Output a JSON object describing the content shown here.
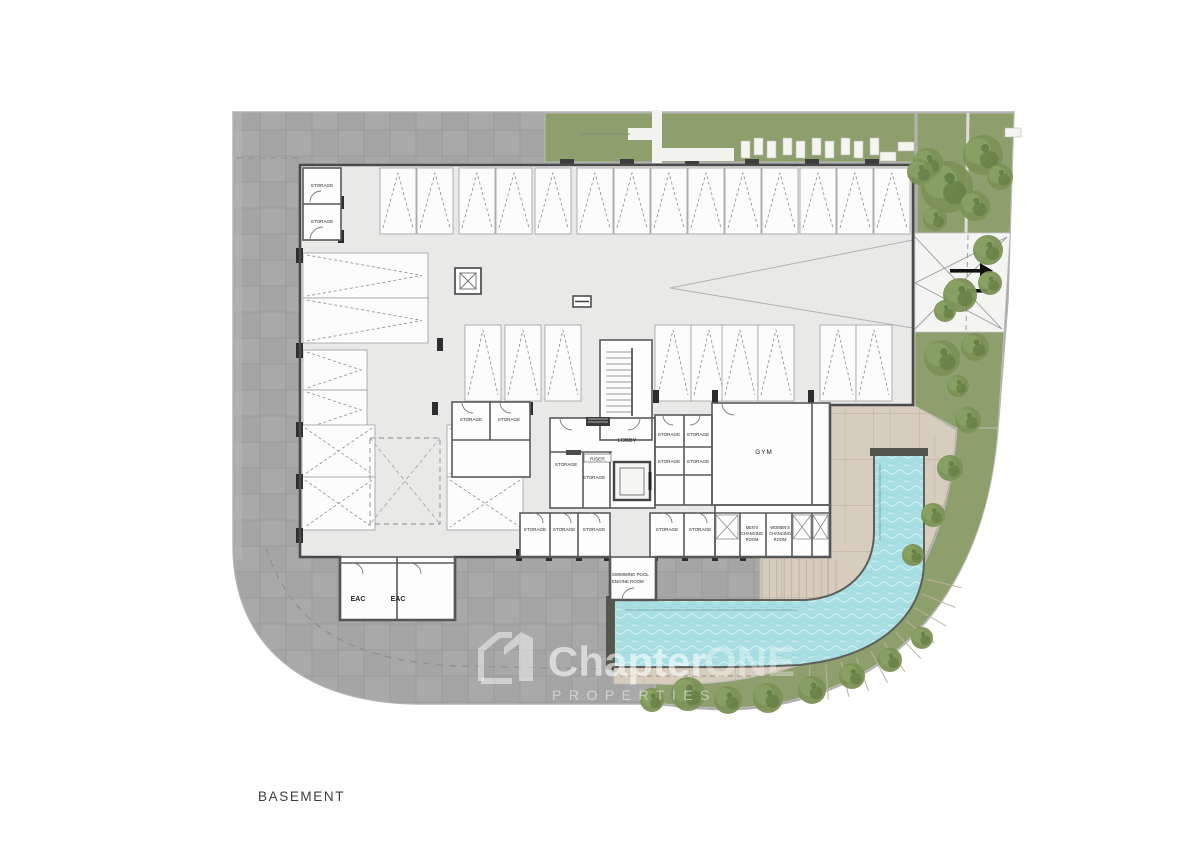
{
  "page": {
    "title": "BASEMENT"
  },
  "watermark": {
    "brand_part1": "Chapter",
    "brand_part2": "ONE",
    "subtitle": "PROPERTIES"
  },
  "labels": {
    "storage": "STORAGE",
    "lobby": "LOBBY",
    "riser": "RISER",
    "gym": "GYM",
    "eac": "EAC",
    "mens_changing": [
      "MEN'S",
      "CHANGING",
      "ROOM"
    ],
    "womens_changing": [
      "WOMEN'S",
      "CHANGING",
      "ROOM"
    ],
    "pool_engine": [
      "SWIMMING POOL",
      "ENGINE ROOM"
    ]
  },
  "colors": {
    "paving": "#a9a9a9",
    "paving_alt": "#a5a5a5",
    "green": "#8d9f6d",
    "floor": "#e9e9e7",
    "deck": "#d6cdbf",
    "pool_water": "#a9dfe3",
    "wall": "#4a4a4a",
    "room_fill": "#fdfdfd"
  }
}
